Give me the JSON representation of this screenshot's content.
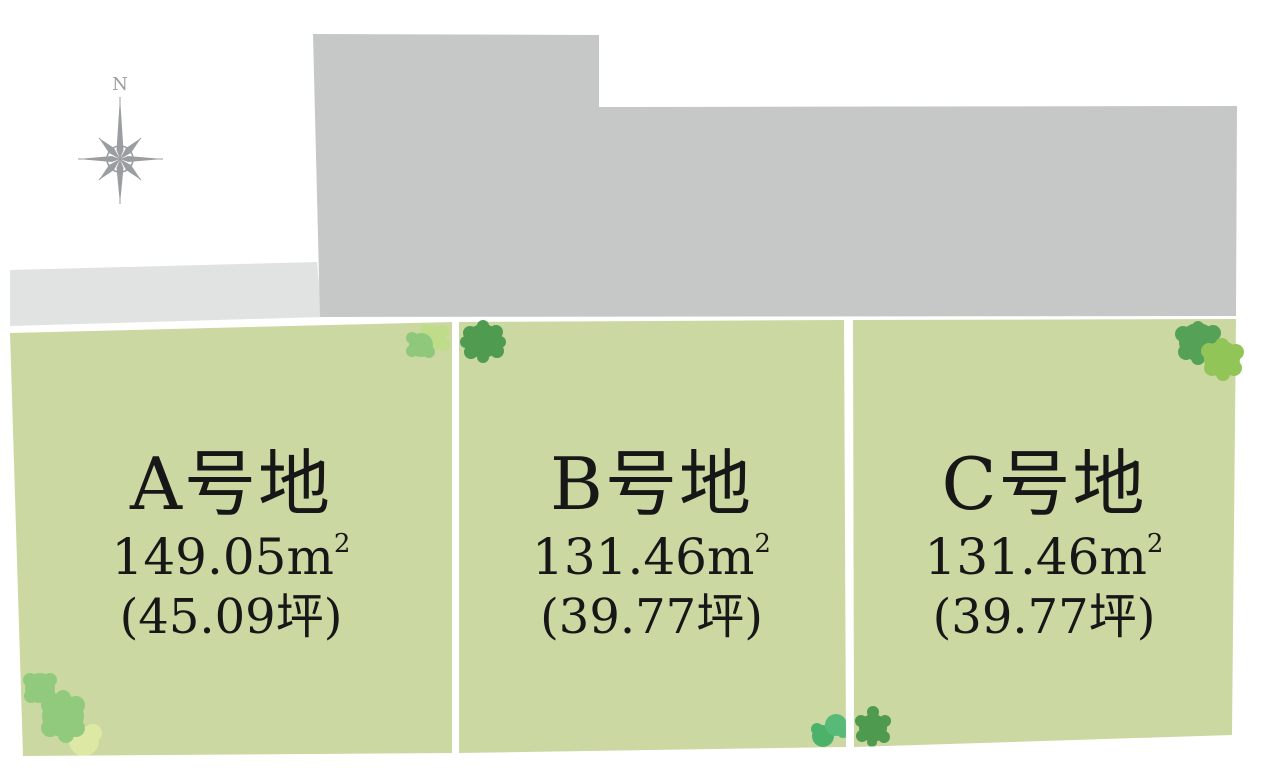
{
  "page": {
    "type": "land-subdivision-site-plan",
    "background": "#ffffff"
  },
  "compass": {
    "north_label": "N",
    "color": "#9b9ea0"
  },
  "units": {
    "area_base": "m",
    "area_exp": "2"
  },
  "parcels": [
    {
      "id": "A",
      "name": "A号地",
      "area_value": "149.05",
      "area_unit": "㎡",
      "tsubo": "(45.09坪)"
    },
    {
      "id": "B",
      "name": "B号地",
      "area_value": "131.46",
      "area_unit": "㎡",
      "tsubo": "(39.77坪)"
    },
    {
      "id": "C",
      "name": "C号地",
      "area_value": "131.46",
      "area_unit": "㎡",
      "tsubo": "(39.77坪)"
    }
  ],
  "colors": {
    "road_main": "#c6c7c7",
    "road_side": "#e1e2e2",
    "parcel_fill": "#cbd8a2",
    "parcel_divider": "#ffffff",
    "label_text": "#171717",
    "tree_medium_green": "#92ca7d",
    "tree_light_green": "#bedc8a",
    "tree_pale_yellow_green": "#dce8a3",
    "tree_dark_green": "#4f9b50",
    "tree_bright_green": "#57bb77",
    "tree_yellow_green": "#92c558"
  }
}
